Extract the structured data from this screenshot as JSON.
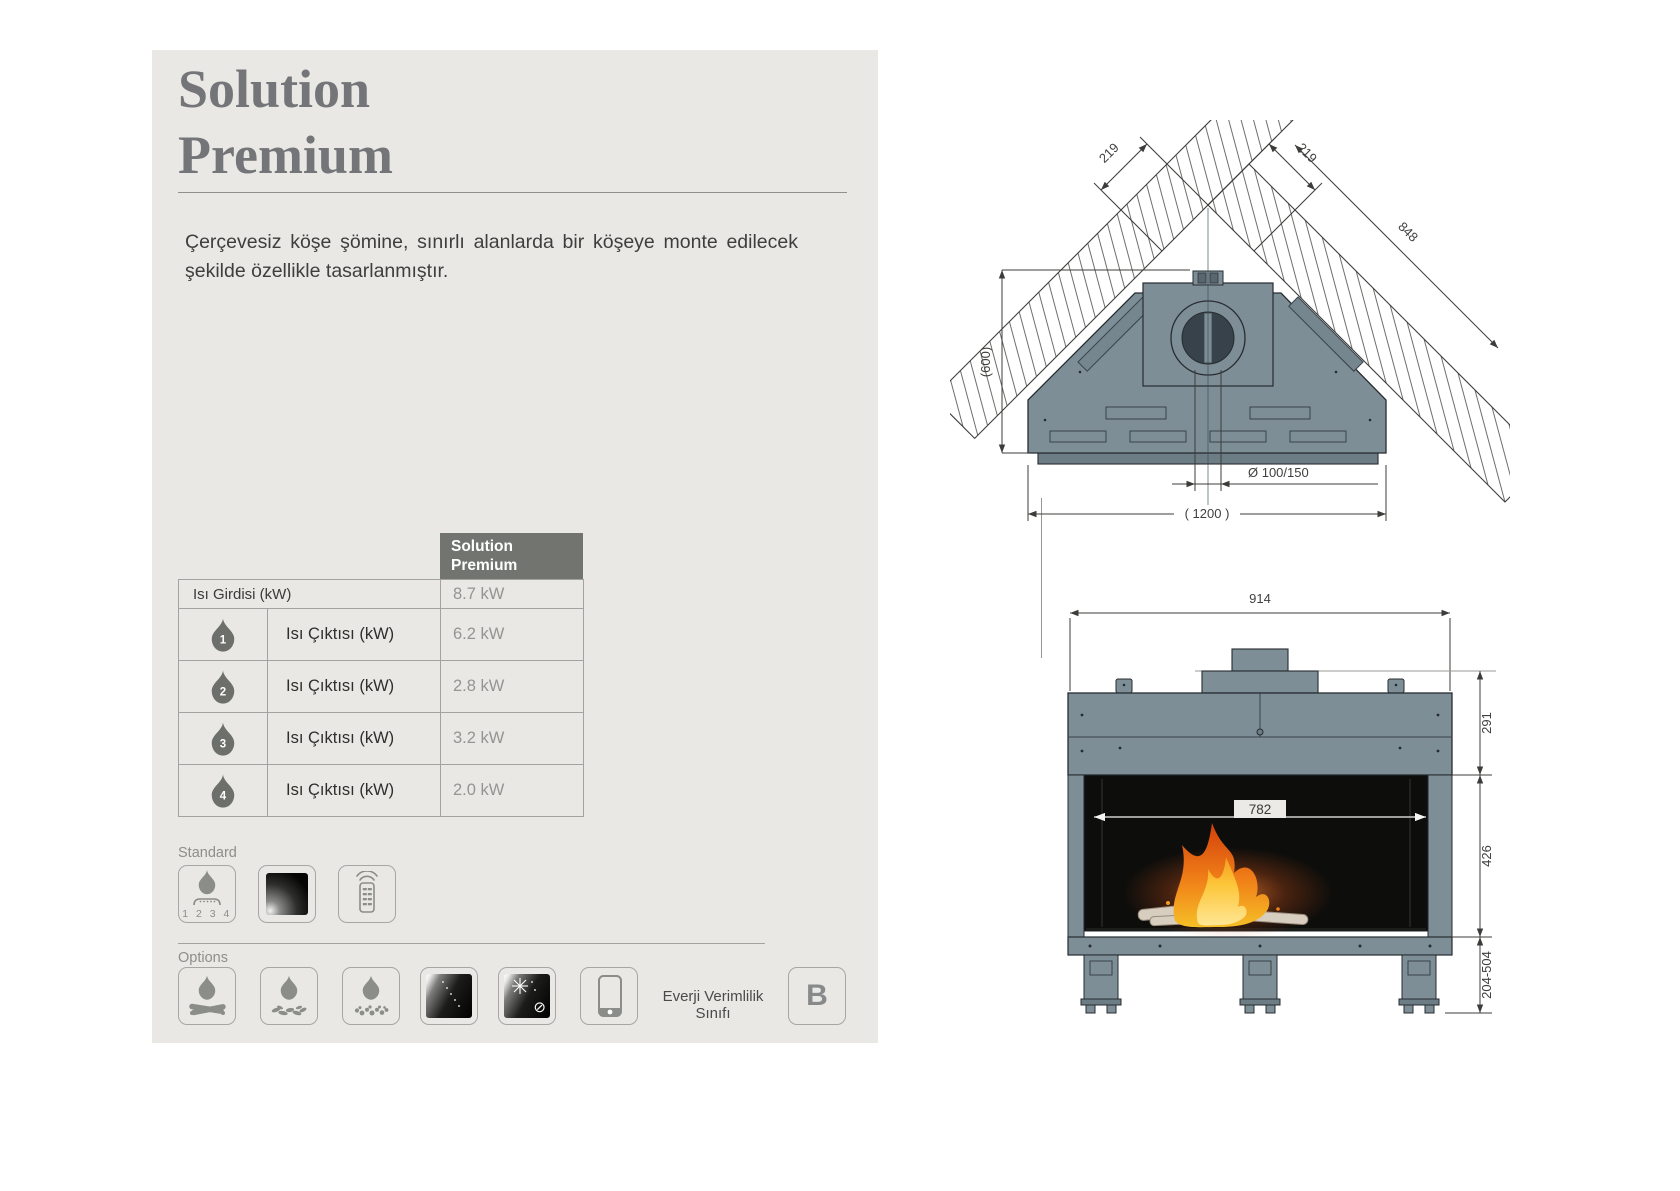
{
  "panel": {
    "title_line1": "Solution",
    "title_line2": "Premium",
    "description": "Çerçevesiz köşe şömine, sınırlı alanlarda bir köşeye monte edilecek şekilde özellikle tasarlanmıştır."
  },
  "spec_table": {
    "header": "Solution Premium",
    "input_row": {
      "label": "Isı Girdisi (kW)",
      "value": "8.7 kW"
    },
    "output_rows": [
      {
        "level": "1",
        "label": "Isı Çıktısı (kW)",
        "value": "6.2 kW"
      },
      {
        "level": "2",
        "label": "Isı Çıktısı (kW)",
        "value": "2.8 kW"
      },
      {
        "level": "3",
        "label": "Isı Çıktısı (kW)",
        "value": "3.2 kW"
      },
      {
        "level": "4",
        "label": "Isı Çıktısı (kW)",
        "value": "2.0 kW"
      }
    ]
  },
  "standard": {
    "label": "Standard",
    "burner_steps": "1 2 3 4",
    "icons": [
      "four-step-burner",
      "black-glass",
      "remote-control"
    ]
  },
  "options": {
    "label": "Options",
    "icons": [
      "log-set",
      "wood-chips",
      "pebbles",
      "glass-panel",
      "anti-reflective-glass",
      "smartphone-app"
    ],
    "no_symbol": "⊘"
  },
  "energy": {
    "label": "Everji Verimlilik Sınıfı",
    "class": "B"
  },
  "top_view": {
    "dim_wall_left": "219",
    "dim_wall_right": "219",
    "dim_wall_outer": "848",
    "dim_depth": "(600)",
    "dim_flue": "Ø 100/150",
    "dim_width": "( 1200 )"
  },
  "front_view": {
    "dim_width": "914",
    "dim_opening": "782",
    "dim_top_height": "291",
    "dim_firebox_height": "426",
    "dim_leg_height": "204-504"
  },
  "colors": {
    "panel_bg": "#e9e8e5",
    "header_bg": "#72756f",
    "body_slate": "#7e8e97"
  }
}
